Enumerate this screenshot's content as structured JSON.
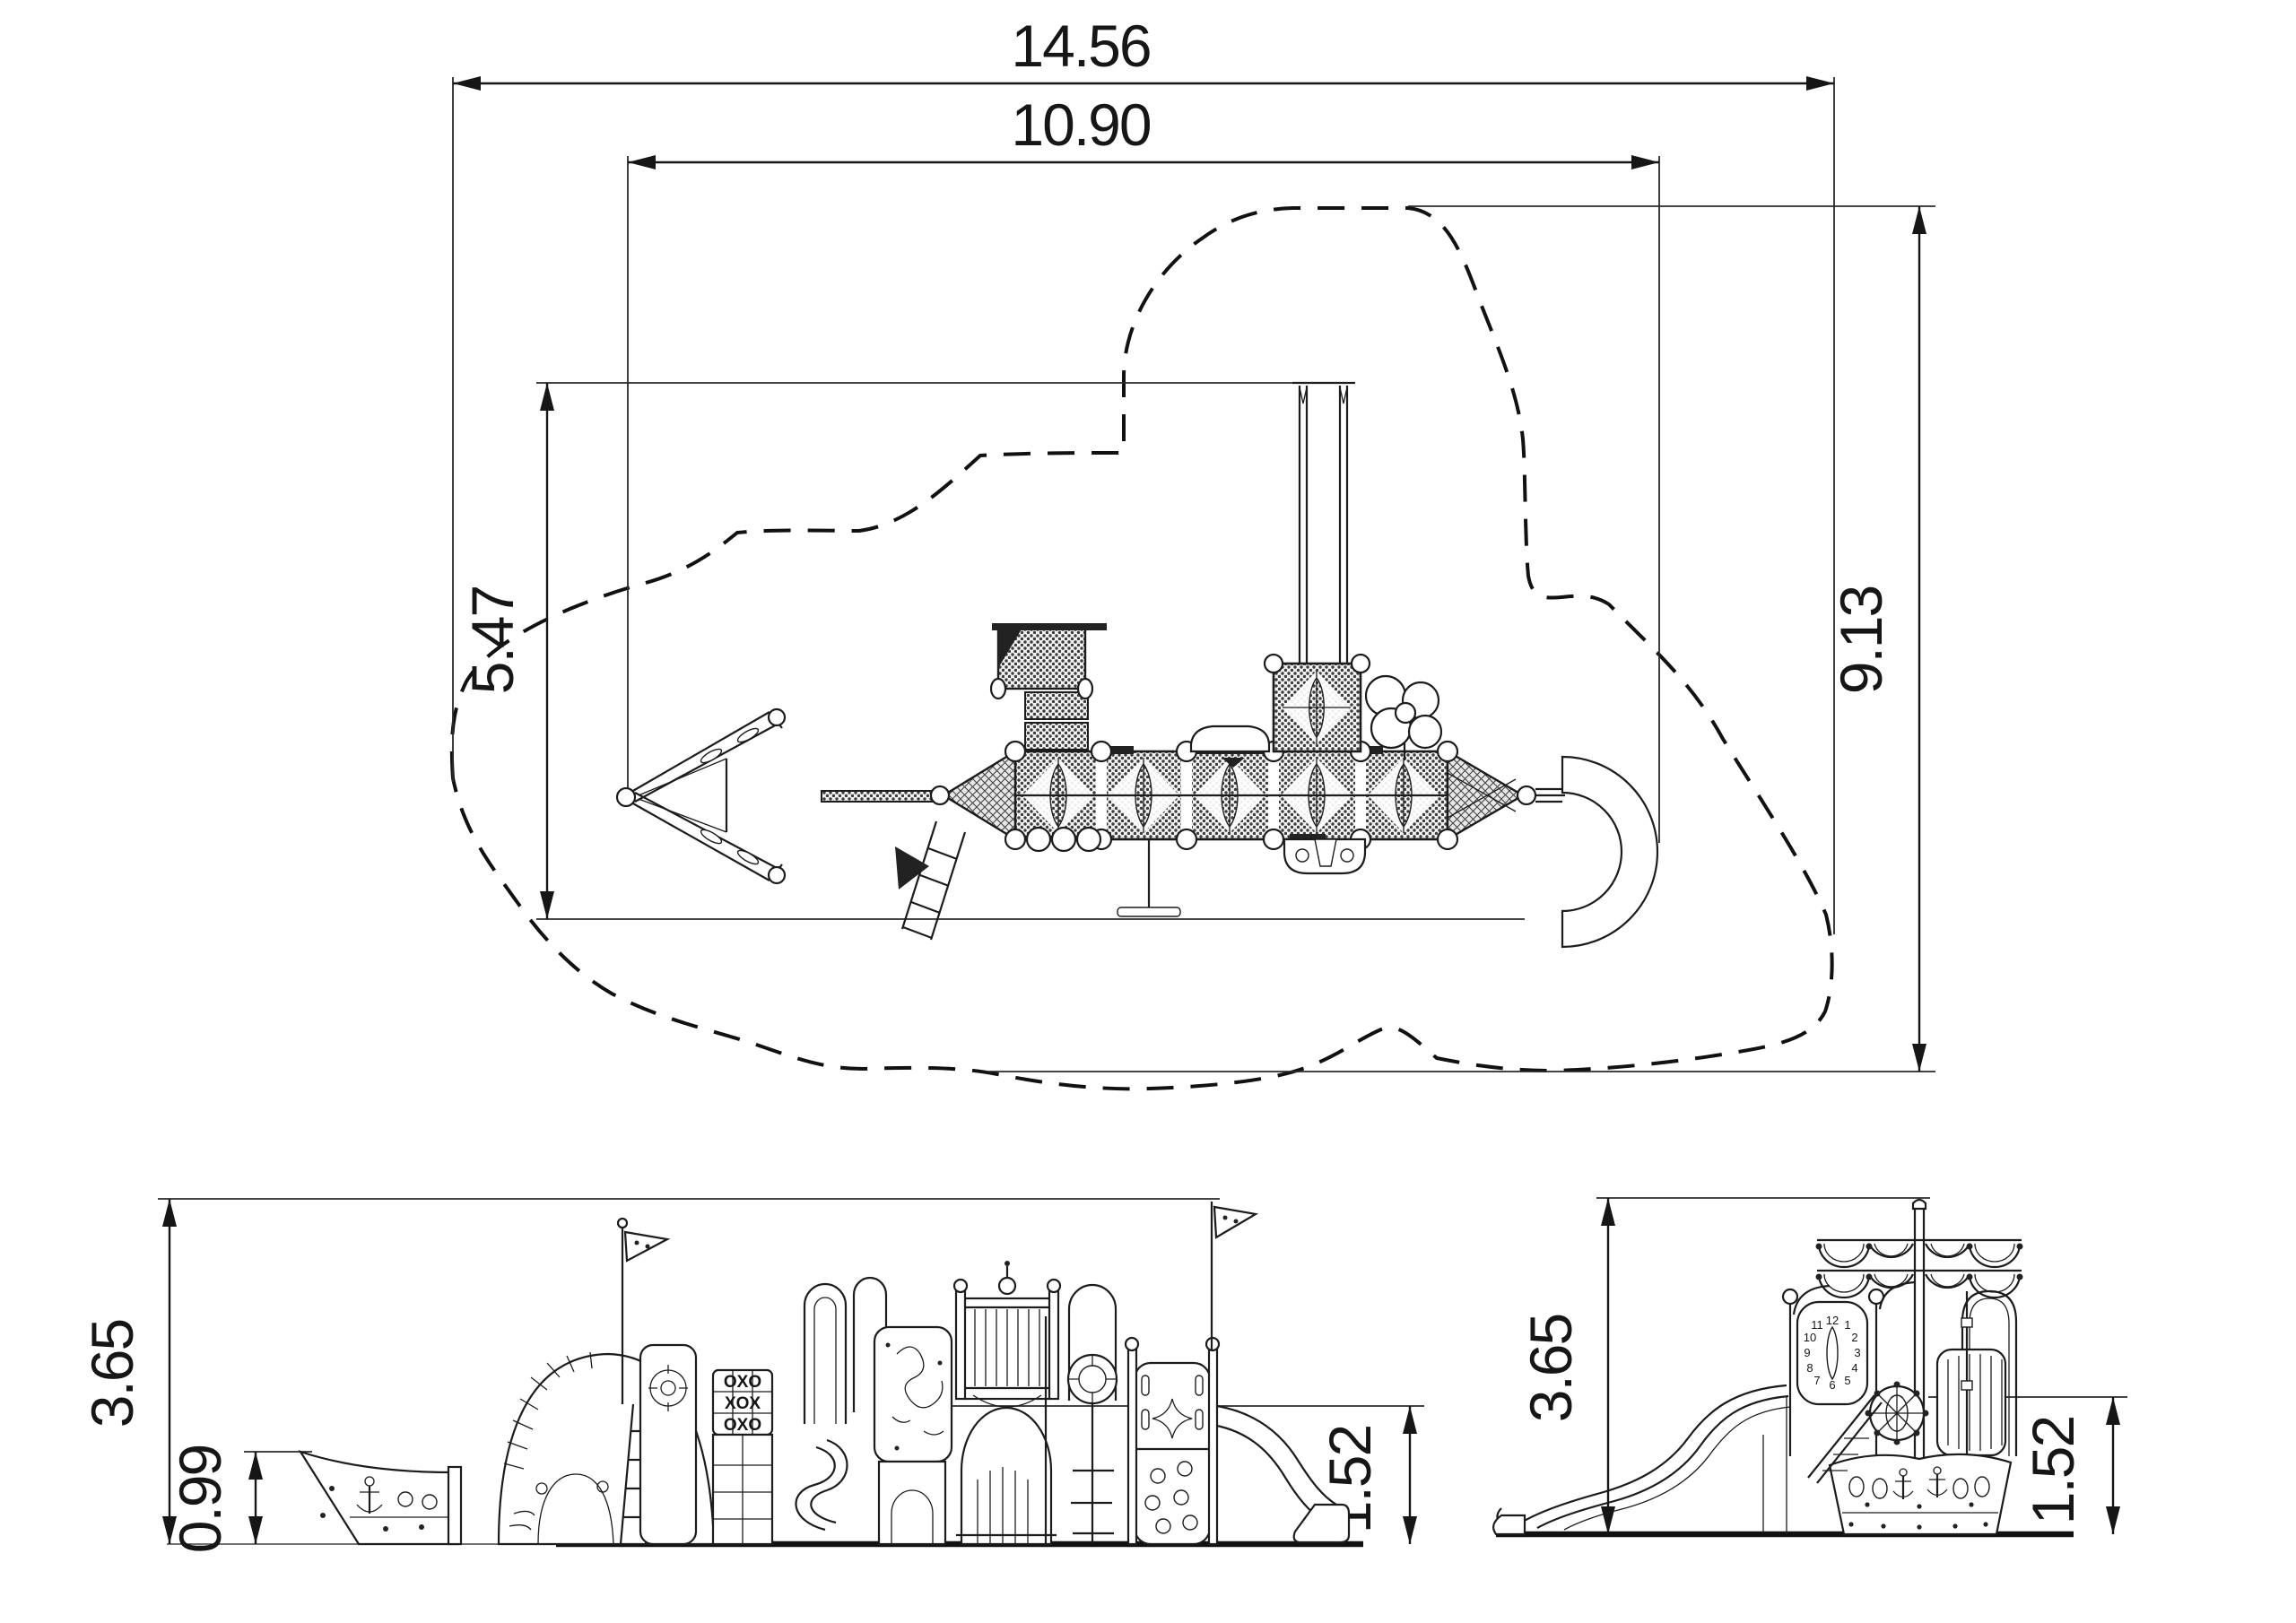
{
  "plan_view": {
    "dimensions": {
      "total_width": "14.56",
      "play_width": "10.90",
      "play_depth": "5.47",
      "total_depth": "9.13"
    }
  },
  "front_elevation": {
    "dimensions": {
      "overall_height": "3.65",
      "bow_height": "0.99",
      "deck_height": "1.52"
    },
    "oxo_rows": [
      "OXO",
      "XOX",
      "OXO"
    ]
  },
  "side_elevation": {
    "dimensions": {
      "overall_height": "3.65",
      "deck_height": "1.52"
    },
    "clock_digits": [
      "12",
      "1",
      "2",
      "3",
      "4",
      "5",
      "6",
      "7",
      "8",
      "9",
      "10",
      "11"
    ]
  },
  "colors": {
    "line": "#1c1c1c",
    "background": "#ffffff"
  }
}
